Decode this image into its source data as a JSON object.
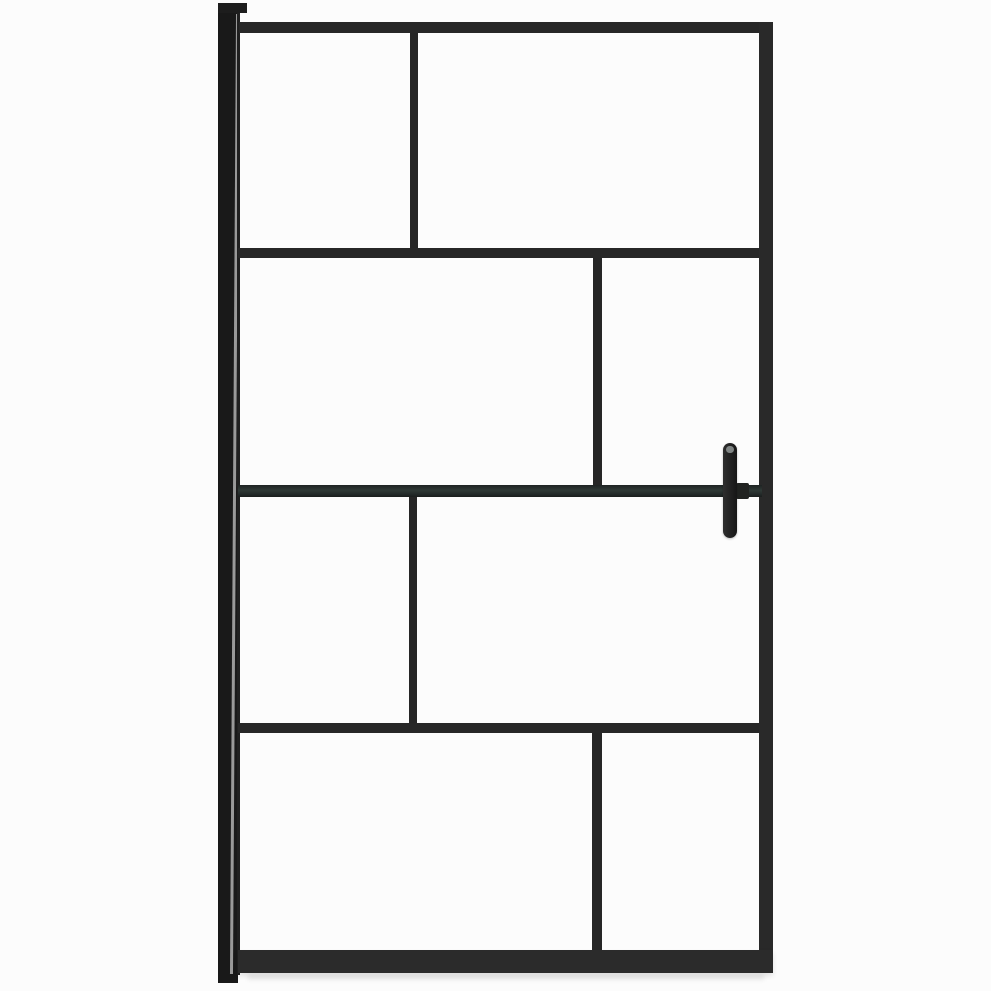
{
  "canvas": {
    "width": 991,
    "height": 991,
    "background": "#fcfcfc"
  },
  "product": {
    "alt": "Walk-in shower screen: clear glass with black metal grid frame, wall profile on the left and vertical handle bar on the right",
    "frame_color": "#272727",
    "wall_profile_color": "#191919",
    "support_bar_tint": "#2f3936",
    "handle_color": "#1c1c1c",
    "glass_color": "#fcfcfc"
  },
  "shapes": [
    {
      "name": "floor-shadow",
      "x": 248,
      "y": 974,
      "w": 516,
      "h": 6,
      "color": "rgba(0,0,0,0.07)",
      "blur": 2
    },
    {
      "name": "wall-profile",
      "x": 218,
      "y": 3,
      "w": 20,
      "h": 980,
      "color": "#191919"
    },
    {
      "name": "wall-profile-cap",
      "x": 218,
      "y": 3,
      "w": 29,
      "h": 10,
      "color": "#1d1d1d"
    },
    {
      "name": "wall-profile-groove-highlight",
      "x": 233,
      "y": 14,
      "w": 2.5,
      "h": 960,
      "color": "#c4c4c4",
      "opacity": 0.75,
      "rotate": 0.36
    },
    {
      "name": "wall-profile-stile-sliver",
      "x": 237,
      "y": 13,
      "w": 3,
      "h": 962,
      "color": "#202020"
    },
    {
      "name": "door-top-rail",
      "x": 239,
      "y": 22,
      "w": 534,
      "h": 11,
      "color": "#272727"
    },
    {
      "name": "door-right-stile",
      "x": 759,
      "y": 22,
      "w": 14,
      "h": 951,
      "color": "#292929"
    },
    {
      "name": "door-bottom-rail",
      "x": 238,
      "y": 950,
      "w": 535,
      "h": 23,
      "color": "#2b2b2b",
      "shadow": "0 3px 5px rgba(0,0,0,0.10)"
    },
    {
      "name": "door-rail-row2",
      "x": 238,
      "y": 248,
      "w": 521,
      "h": 10,
      "color": "#272727"
    },
    {
      "name": "door-rail-row4",
      "x": 238,
      "y": 723,
      "w": 521,
      "h": 10,
      "color": "#272727"
    },
    {
      "name": "mullion-row1",
      "x": 410,
      "y": 33,
      "w": 8,
      "h": 215,
      "color": "#262626"
    },
    {
      "name": "mullion-row2",
      "x": 593,
      "y": 258,
      "w": 9,
      "h": 227,
      "color": "#262626"
    },
    {
      "name": "mullion-row3",
      "x": 409,
      "y": 497,
      "w": 8,
      "h": 226,
      "color": "#262626"
    },
    {
      "name": "mullion-row4",
      "x": 592,
      "y": 733,
      "w": 10,
      "h": 217,
      "color": "#262626"
    },
    {
      "name": "support-bar",
      "x": 238,
      "y": 485,
      "w": 524,
      "h": 12,
      "gradient": [
        "#1e2322",
        "#2f3936 45%",
        "#242b2a 75%",
        "#1a1e1d"
      ],
      "dir": "180deg"
    },
    {
      "name": "handle-clamp",
      "x": 736,
      "y": 483,
      "w": 13,
      "h": 16,
      "color": "#212321",
      "radius": 2
    },
    {
      "name": "door-handle-grip",
      "x": 723,
      "y": 443,
      "w": 14,
      "h": 95,
      "gradient": [
        "#2e2e2e",
        "#161616"
      ],
      "dir": "90deg",
      "radius": 7,
      "shadow": "0 1px 2px rgba(0,0,0,0.25)"
    },
    {
      "name": "handle-top-highlight",
      "x": 726,
      "y": 446,
      "w": 8,
      "h": 7,
      "color": "#909795",
      "radius": 4,
      "opacity": 0.85
    }
  ]
}
